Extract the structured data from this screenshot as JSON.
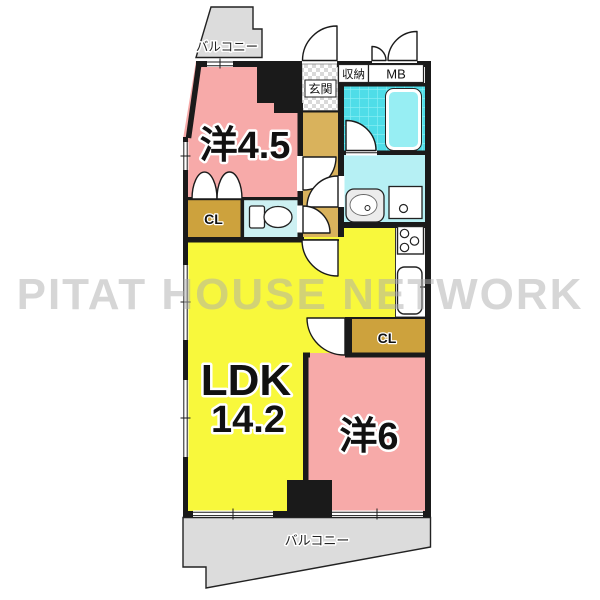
{
  "watermark": {
    "text": "PITAT HOUSE NETWORK"
  },
  "colors": {
    "room_pink": "#f7aaa9",
    "room_yellow": "#f8f83c",
    "closet_tan": "#cda23d",
    "hallway_tan": "#d9b25c",
    "bath_tile": "#4fdde8",
    "bathtub": "#97eef3",
    "washroom": "#b6f0f4",
    "toilet_room": "#cdf0f2",
    "balcony_gray": "#dcdcdc",
    "wall": "#1a1a1a"
  },
  "floor_plan": {
    "rooms": {
      "western_room_45": {
        "label": "洋4.5"
      },
      "ldk": {
        "label": "LDK",
        "area": "14.2"
      },
      "western_room_6": {
        "label": "洋6"
      },
      "closet_1": {
        "label": "CL"
      },
      "closet_2": {
        "label": "CL"
      },
      "entrance": {
        "label": "玄関"
      },
      "storage": {
        "label": "収納"
      },
      "meter_box": {
        "label": "MB"
      },
      "balcony_top": {
        "label": "バルコニー"
      },
      "balcony_bottom": {
        "label": "バルコニー"
      }
    }
  }
}
